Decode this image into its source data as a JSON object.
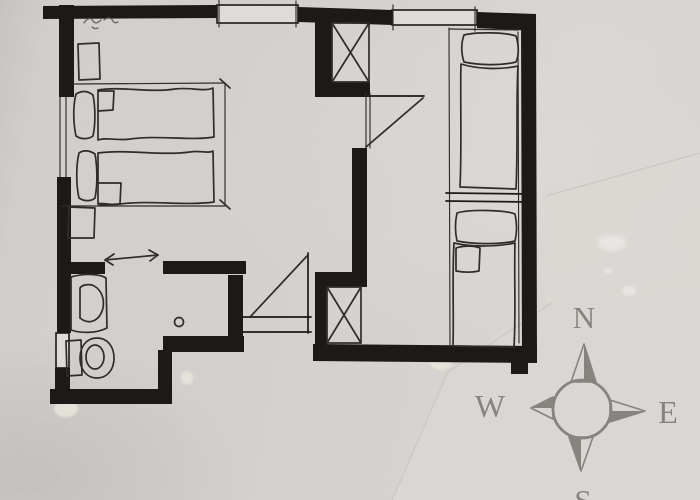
{
  "scene": {
    "description": "Hand-drawn floor plan sketch photographed on grey paper, compass card taped at lower right",
    "visible_text": [
      "N",
      "W",
      "E",
      "S"
    ]
  },
  "compass": {
    "north": "N",
    "west": "W",
    "east": "E",
    "south": "S"
  },
  "colors": {
    "paper": "#d3d1cd",
    "paper-light": "#dedcd8",
    "ink": "#1b1a18",
    "sketch": "#2f2d2a",
    "compass": "#85847e",
    "compass-letter": "#7f7e78",
    "tape": "#dad8d4",
    "compass-paper": "#d9d7d3",
    "tape-shine": "#edebe7",
    "cream-tape": "#e7e4db"
  },
  "legend": {
    "beds": 4,
    "windows": 4,
    "x_shafts": 2,
    "door_swings": 2,
    "fixtures": [
      "sink",
      "toilet",
      "floor-drain"
    ],
    "annotations": [
      "dimension-lines",
      "double-arrow-door",
      "pencil-scribble"
    ]
  }
}
